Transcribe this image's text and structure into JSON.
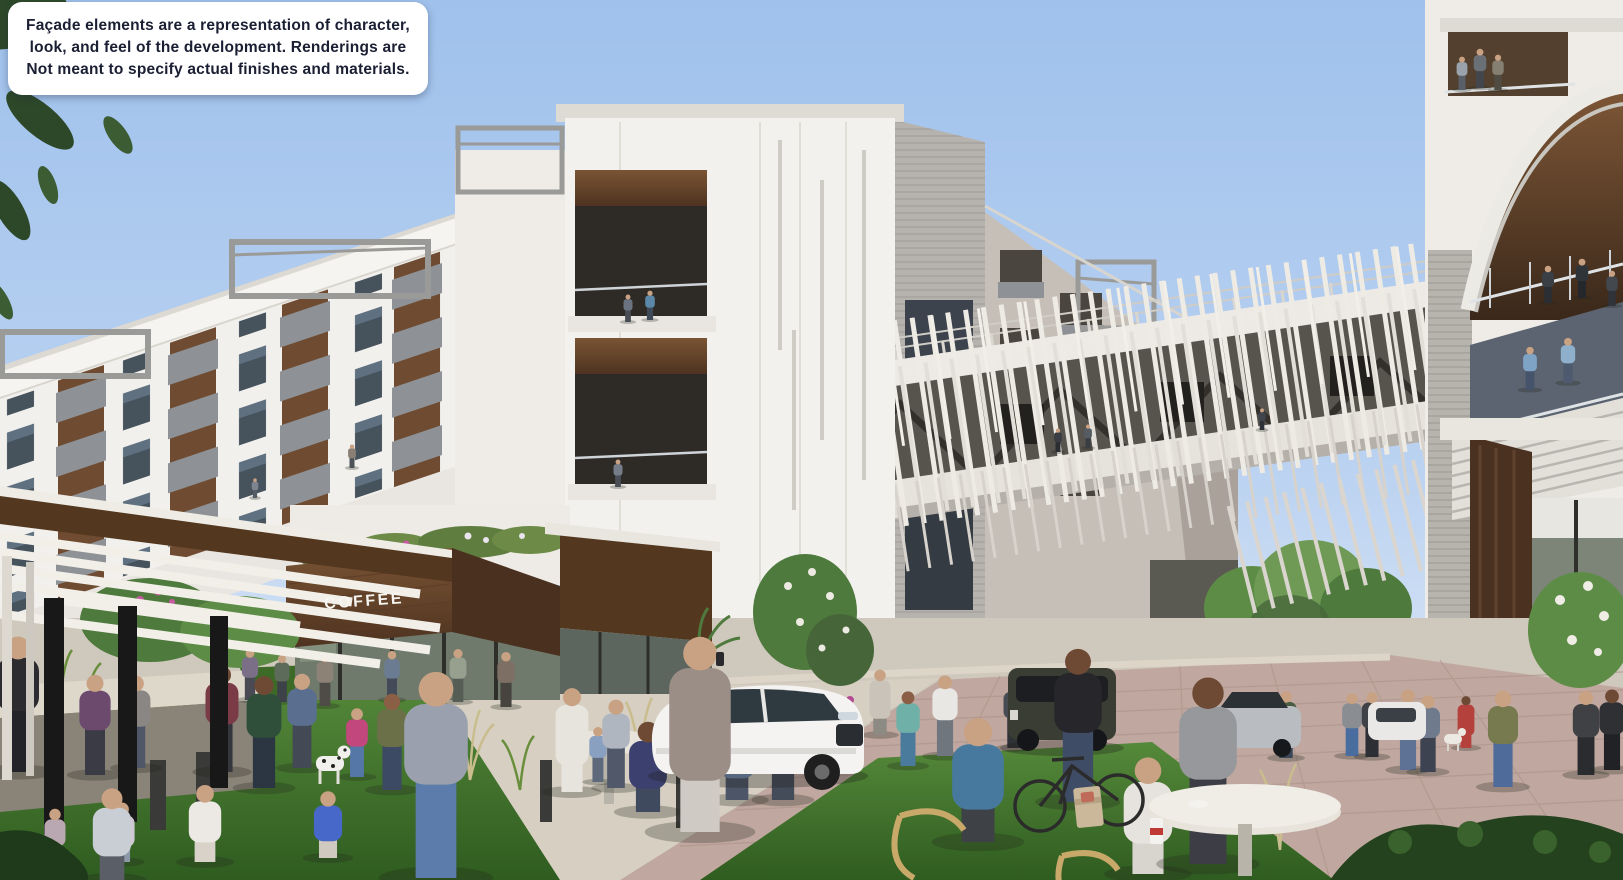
{
  "disclaimer": {
    "text": "Façade elements are a representation of character, look, and feel of the development. Renderings are Not meant to specify actual finishes and materials.",
    "lines": [
      "Façade elements are a representation of character,",
      "look, and feel of the development. Renderings are",
      "Not meant to specify actual finishes and materials."
    ]
  },
  "signs": {
    "coffee": "COFFEE"
  },
  "colors": {
    "sky_top": "#9fc1ec",
    "sky_horizon": "#dde8f6",
    "facade_white": "#f2f0ec",
    "facade_shade": "#d9d6d0",
    "panel_gray": "#8e9296",
    "siding_gray": "#b6b3ae",
    "window_glass": "#46525c",
    "wood_dark": "#4e3320",
    "wood_mid": "#6f4a2e",
    "bridge_fin_white": "#eeebe5",
    "truss_dark": "#57534d",
    "grass_light": "#55893a",
    "grass_dark": "#2f5c20",
    "foliage_dark": "#2d4829",
    "tree_green": "#5d8c46",
    "pavement_concrete": "#d6cfc2",
    "pavement_brick": "#c0a8a0",
    "disclaimer_text": "#1b1f33",
    "coffee_sign_text": "#f7f5f1"
  },
  "scene": {
    "description": "Architectural rendering of a mixed-use residential development: white apartment buildings with balconies, a slatted pedestrian sky-bridge connecting to a curved tower, a COFFEE shop with wood fascia, landscaped plaza with lawns, cafe tables, pedestrians, a cyclist, a dog and cars under a clear blue sky.",
    "people_bg": [
      {
        "x": 255,
        "y": 498,
        "h": 22,
        "shirt": "#7d8490",
        "pants": "#565c66"
      },
      {
        "x": 352,
        "y": 468,
        "h": 26,
        "shirt": "#8a7f74",
        "pants": "#4d5258"
      },
      {
        "x": 628,
        "y": 322,
        "h": 30,
        "shirt": "#6b7280",
        "pants": "#474c55"
      },
      {
        "x": 650,
        "y": 320,
        "h": 32,
        "shirt": "#5b88a8",
        "pants": "#3e4a58"
      },
      {
        "x": 618,
        "y": 487,
        "h": 30,
        "shirt": "#777d88",
        "pants": "#4a4f58"
      },
      {
        "x": 1548,
        "y": 303,
        "h": 40,
        "shirt": "#3a3f46",
        "pants": "#2b2e33"
      },
      {
        "x": 1582,
        "y": 298,
        "h": 42,
        "shirt": "#2f3438",
        "pants": "#24272b"
      },
      {
        "x": 1612,
        "y": 306,
        "h": 38,
        "shirt": "#43484e",
        "pants": "#30343a"
      },
      {
        "x": 1530,
        "y": 390,
        "h": 46,
        "shirt": "#7fa3c4",
        "pants": "#45536b"
      },
      {
        "x": 1568,
        "y": 383,
        "h": 48,
        "shirt": "#8fb0cc",
        "pants": "#4d5a70"
      },
      {
        "x": 1462,
        "y": 90,
        "h": 36,
        "shirt": "#9aa2ab",
        "pants": "#5a6068"
      },
      {
        "x": 1480,
        "y": 88,
        "h": 42,
        "shirt": "#6b7077",
        "pants": "#43474d"
      },
      {
        "x": 1498,
        "y": 90,
        "h": 38,
        "shirt": "#857f72",
        "pants": "#504c44"
      },
      {
        "x": 1058,
        "y": 452,
        "h": 26,
        "shirt": "#3a3e44",
        "pants": "#2a2d31"
      },
      {
        "x": 1088,
        "y": 448,
        "h": 26,
        "shirt": "#565c64",
        "pants": "#3a3e44"
      },
      {
        "x": 1262,
        "y": 430,
        "h": 24,
        "shirt": "#40454c",
        "pants": "#2e3238"
      },
      {
        "x": 1286,
        "y": 758,
        "h": 70,
        "shirt": "#4a5d43",
        "pants": "#3a4555"
      },
      {
        "x": 1352,
        "y": 756,
        "h": 66,
        "shirt": "#8a8d91",
        "pants": "#4a6da0"
      },
      {
        "x": 1372,
        "y": 757,
        "h": 68,
        "shirt": "#3f4246",
        "pants": "#2c2f34"
      },
      {
        "x": 1466,
        "y": 748,
        "h": 56,
        "shirt": "#b5413c",
        "pants": "#b5413c",
        "pose": "dress",
        "skin": "#6e4a35"
      },
      {
        "x": 908,
        "y": 766,
        "h": 78,
        "shirt": "#6fb0a8",
        "pants": "#4a7b9c",
        "skin": "#8a5f45"
      },
      {
        "x": 945,
        "y": 756,
        "h": 84,
        "shirt": "#e9e7e3",
        "pants": "#70767d"
      },
      {
        "x": 1014,
        "y": 748,
        "h": 70,
        "shirt": "#474b52",
        "pants": "#2e3136"
      },
      {
        "x": 572,
        "y": 792,
        "h": 110,
        "shirt": "#e7e3dd",
        "pants": "#e7e3dd",
        "pose": "dress"
      },
      {
        "x": 598,
        "y": 782,
        "h": 58,
        "shirt": "#8aa0c0",
        "pants": "#5e6a7c"
      },
      {
        "x": 616,
        "y": 788,
        "h": 92,
        "shirt": "#b0b6bf",
        "pants": "#50586a"
      },
      {
        "x": 432,
        "y": 768,
        "h": 78,
        "shirt": "#cf6d2b",
        "pants": "#4d5560",
        "skin": "#6e4a35"
      },
      {
        "x": 250,
        "y": 700,
        "h": 54,
        "shirt": "#7a6f86",
        "pants": "#4a4a55"
      },
      {
        "x": 282,
        "y": 702,
        "h": 50,
        "shirt": "#5d6b5a",
        "pants": "#3d4248"
      },
      {
        "x": 325,
        "y": 706,
        "h": 56,
        "shirt": "#8d8276",
        "pants": "#4f4b47"
      },
      {
        "x": 392,
        "y": 700,
        "h": 52,
        "shirt": "#6b7c92",
        "pants": "#434b58"
      },
      {
        "x": 458,
        "y": 702,
        "h": 56,
        "shirt": "#97a08f",
        "pants": "#555d55"
      },
      {
        "x": 506,
        "y": 707,
        "h": 58,
        "shirt": "#7d6f63",
        "pants": "#474440"
      },
      {
        "x": 357,
        "y": 777,
        "h": 72,
        "shirt": "#c2477d",
        "pants": "#5577a8"
      },
      {
        "x": 392,
        "y": 790,
        "h": 100,
        "shirt": "#6b7049",
        "pants": "#3c4a63",
        "skin": "#8a5f45"
      },
      {
        "x": 648,
        "y": 812,
        "h": 126,
        "shirt": "#3c406e",
        "pants": "#3f4a5e",
        "pose": "seated",
        "skin": "#6e4a35"
      },
      {
        "x": 737,
        "y": 800,
        "h": 118,
        "shirt": "#7289ad",
        "pants": "#4c5668",
        "pose": "seated"
      },
      {
        "x": 783,
        "y": 800,
        "h": 116,
        "shirt": "#6d82a4",
        "pants": "#454c59"
      },
      {
        "x": 18,
        "y": 772,
        "h": 140,
        "shirt": "#2b2b30",
        "pants": "#23232a"
      },
      {
        "x": 95,
        "y": 775,
        "h": 104,
        "shirt": "#6b4a6e",
        "pants": "#3b3b46"
      },
      {
        "x": 136,
        "y": 768,
        "h": 96,
        "shirt": "#8a8684",
        "pants": "#4e5668"
      },
      {
        "x": 222,
        "y": 772,
        "h": 110,
        "shirt": "#7a3b47",
        "pants": "#36363f",
        "skin": "#6e4a35"
      },
      {
        "x": 264,
        "y": 788,
        "h": 116,
        "shirt": "#2f4f3a",
        "pants": "#2c3642",
        "skin": "#6e4a35"
      },
      {
        "x": 302,
        "y": 768,
        "h": 98,
        "shirt": "#5a6f8f",
        "pants": "#444a55"
      },
      {
        "x": 1503,
        "y": 787,
        "h": 100,
        "shirt": "#77794f",
        "pants": "#4f6b9a"
      },
      {
        "x": 1586,
        "y": 775,
        "h": 88,
        "shirt": "#3f4145",
        "pants": "#2a2c30"
      },
      {
        "x": 1612,
        "y": 770,
        "h": 84,
        "shirt": "#2e3033",
        "pants": "#202226",
        "skin": "#6e4a35"
      },
      {
        "x": 1408,
        "y": 770,
        "h": 84,
        "shirt": "#b9b3c7",
        "pants": "#5e7296"
      },
      {
        "x": 1428,
        "y": 772,
        "h": 80,
        "shirt": "#6f7b8d",
        "pants": "#3d4350"
      },
      {
        "x": 880,
        "y": 735,
        "h": 70,
        "shirt": "#c9c3ba",
        "pants": "#8d8a84",
        "pose": "dress"
      }
    ],
    "people_fg": [
      {
        "x": 700,
        "y": 832,
        "h": 205,
        "shirt": "#9b8e87",
        "pants": "#cfcac4",
        "pose": "dress"
      },
      {
        "x": 436,
        "y": 878,
        "h": 212,
        "shirt": "#9aa0ad",
        "pants": "#5c7cab"
      },
      {
        "x": 978,
        "y": 842,
        "h": 172,
        "shirt": "#47799f",
        "pants": "#3e4146",
        "pose": "seated"
      },
      {
        "x": 1148,
        "y": 874,
        "h": 162,
        "shirt": "#e6e3de",
        "pants": "#d8d5cf",
        "pose": "seated"
      },
      {
        "x": 1078,
        "y": 802,
        "h": 158,
        "shirt": "#26262b",
        "pants": "#3f4c66",
        "skin": "#6e4a35"
      },
      {
        "x": 1208,
        "y": 864,
        "h": 192,
        "shirt": "#97989c",
        "pants": "#3c3d45",
        "skin": "#6e4a35"
      },
      {
        "x": 328,
        "y": 858,
        "h": 94,
        "shirt": "#4768c8",
        "pants": "#cfc9bf",
        "pose": "seated"
      },
      {
        "x": 205,
        "y": 862,
        "h": 108,
        "shirt": "#ece9e4",
        "pants": "#d8d2c8",
        "pose": "seated"
      },
      {
        "x": 122,
        "y": 862,
        "h": 84,
        "shirt": "#cfc8d2",
        "pants": "#8d98a8",
        "pose": "seated"
      },
      {
        "x": 55,
        "y": 858,
        "h": 70,
        "shirt": "#b9a8b2",
        "pants": "#7d8a97",
        "pose": "seated"
      },
      {
        "x": 112,
        "y": 880,
        "h": 128,
        "shirt": "#c9cdd4",
        "pants": "#5a5e66",
        "pose": "seated"
      }
    ]
  }
}
